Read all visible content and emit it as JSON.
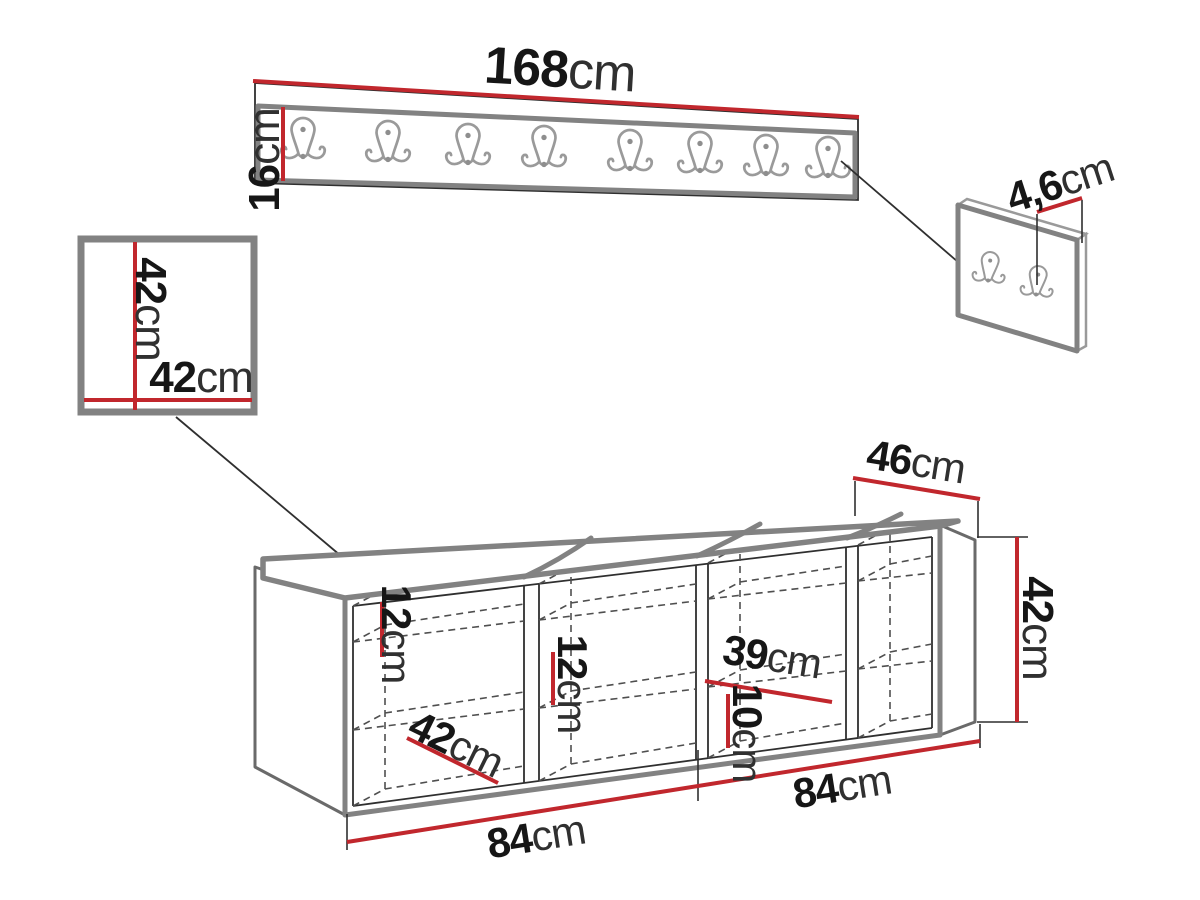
{
  "diagram_title": "hallway furniture set dimension drawing",
  "unit": "cm",
  "colors": {
    "dimension_red": "#c1272d",
    "outline_gray": "#828282",
    "line_black": "#2f2f2f",
    "hook_gray": "#9a9a9a"
  },
  "coat_rack": {
    "hook_count": 8
  },
  "hook_panel": {
    "hook_count": 2
  },
  "bench": {
    "compartment_count": 4,
    "cushion_count": 4
  },
  "labels": {
    "rack_width": {
      "num": "168",
      "unit": "cm"
    },
    "rack_height": {
      "num": "16",
      "unit": "cm"
    },
    "hook_panel_thickness": {
      "num": "4,6",
      "unit": "cm"
    },
    "wall_panel_height": {
      "num": "42",
      "unit": "cm"
    },
    "wall_panel_width": {
      "num": "42",
      "unit": "cm"
    },
    "bench_depth": {
      "num": "46",
      "unit": "cm"
    },
    "bench_height": {
      "num": "42",
      "unit": "cm"
    },
    "bench_shelf_gap_1": {
      "num": "12",
      "unit": "cm"
    },
    "bench_shelf_gap_2": {
      "num": "12",
      "unit": "cm"
    },
    "bench_shelf_width": {
      "num": "39",
      "unit": "cm"
    },
    "bench_shelf_gap_3": {
      "num": "10",
      "unit": "cm"
    },
    "bench_inner_width": {
      "num": "42",
      "unit": "cm"
    },
    "bench_module_left": {
      "num": "84",
      "unit": "cm"
    },
    "bench_module_right": {
      "num": "84",
      "unit": "cm"
    }
  }
}
